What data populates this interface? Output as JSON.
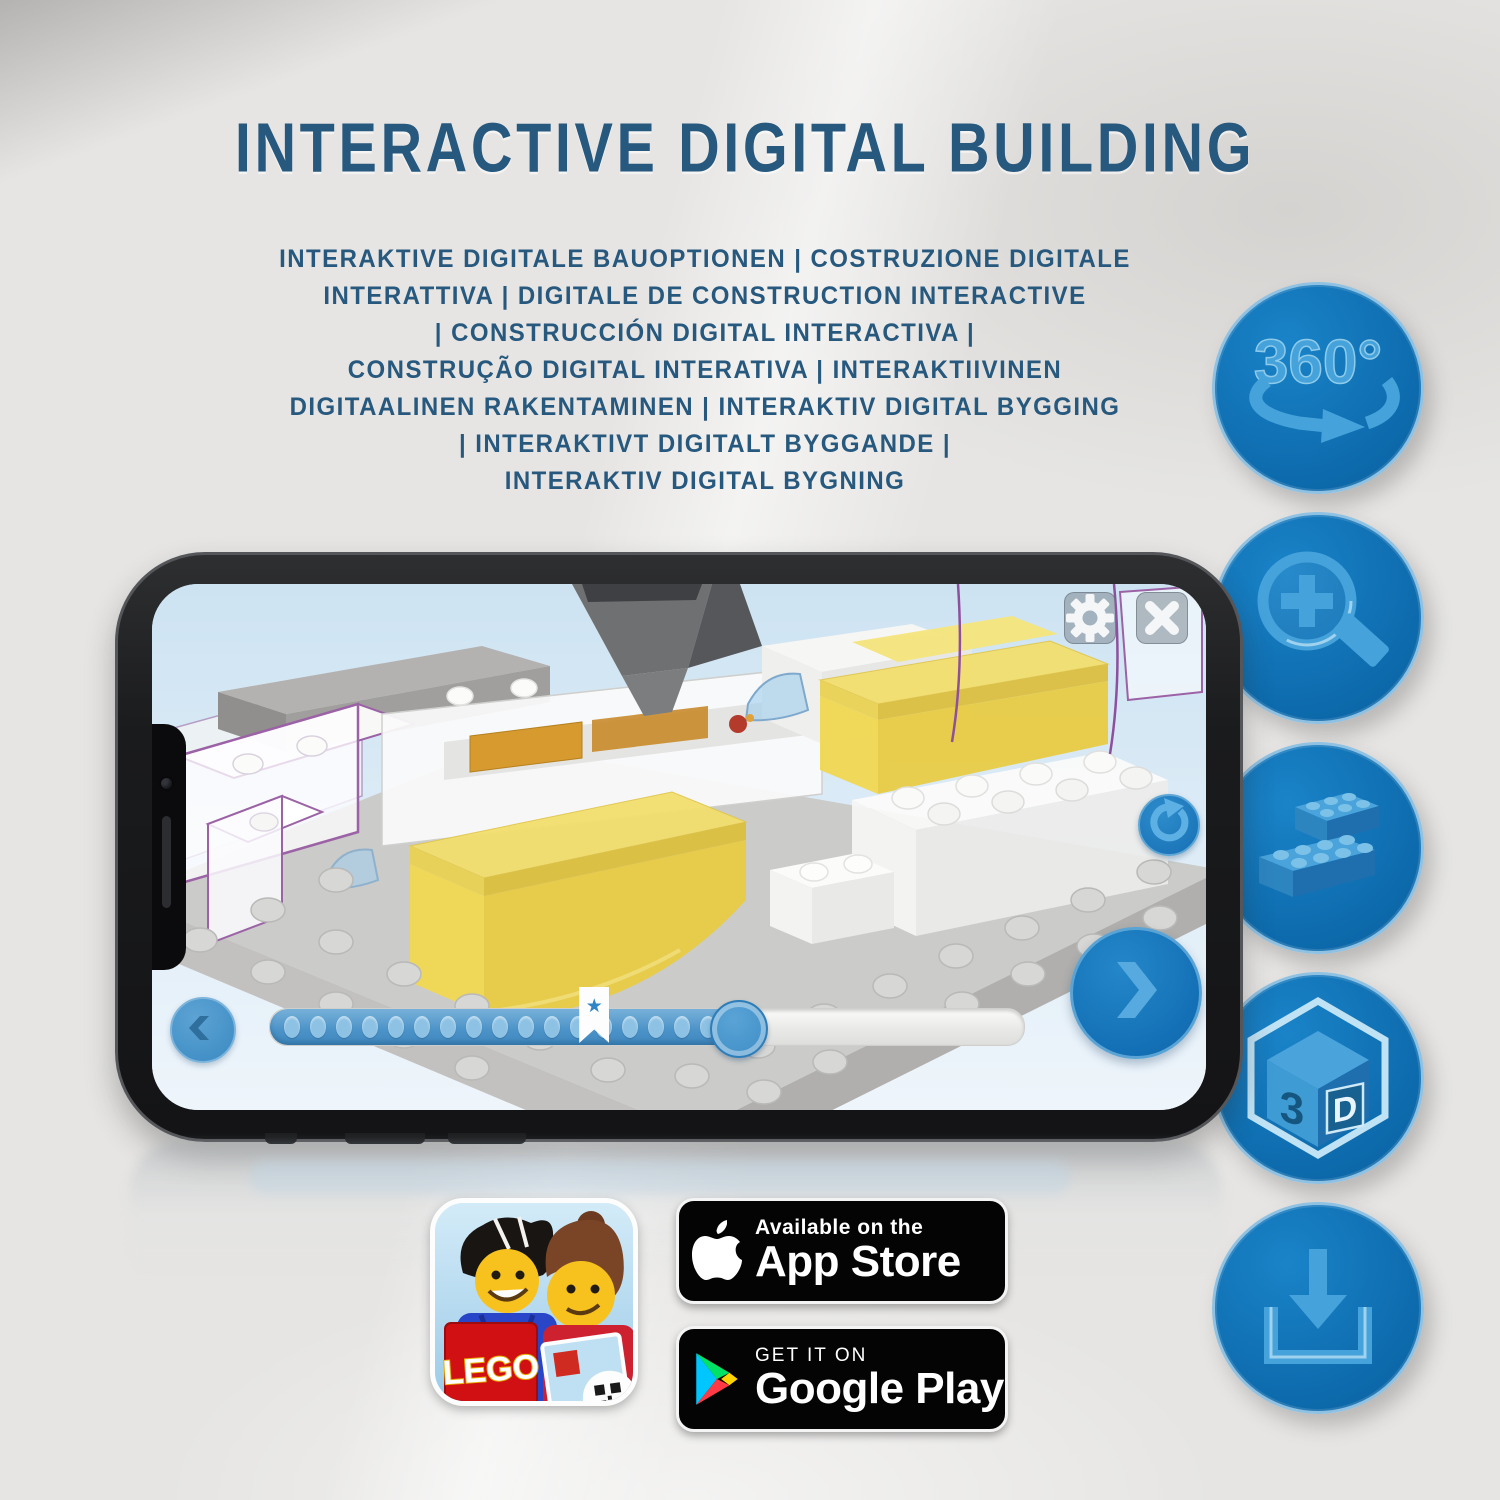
{
  "header": {
    "title": "INTERACTIVE DIGITAL BUILDING",
    "subtitle_lines": [
      "INTERAKTIVE DIGITALE BAUOPTIONEN | COSTRUZIONE DIGITALE",
      "INTERATTIVA | DIGITALE DE CONSTRUCTION INTERACTIVE",
      "| CONSTRUCCIÓN DIGITAL INTERACTIVA |",
      "CONSTRUÇÃO DIGITAL INTERATIVA | INTERAKTIIVINEN",
      "DIGITAALINEN RAKENTAMINEN | INTERAKTIV DIGITAL BYGGING",
      "| INTERAKTIVT DIGITALT BYGGANDE |",
      "INTERAKTIV DIGITAL BYGNING"
    ]
  },
  "features": {
    "rotate_label": "360°",
    "threed_left": "3",
    "threed_right": "D",
    "icon_names": [
      "360-rotation-icon",
      "zoom-in-icon",
      "brick-options-icon",
      "3d-view-icon",
      "download-icon"
    ]
  },
  "builder_app": {
    "progress_percent": 62,
    "bookmark_percent": 43
  },
  "store": {
    "app_icon_logo": "LEGO",
    "app_store": {
      "tagline": "Available on the",
      "name": "App Store"
    },
    "google_play": {
      "tagline": "GET IT ON",
      "name": "Google Play"
    }
  },
  "colors": {
    "title_blue": "#27587E",
    "feature_circle_blue": "#0E6FB3",
    "feature_icon_blue": "#45A2DA",
    "app_accent_blue": "#2F88C7",
    "lego_yellow": "#F0D64F",
    "lego_red": "#D01012"
  }
}
